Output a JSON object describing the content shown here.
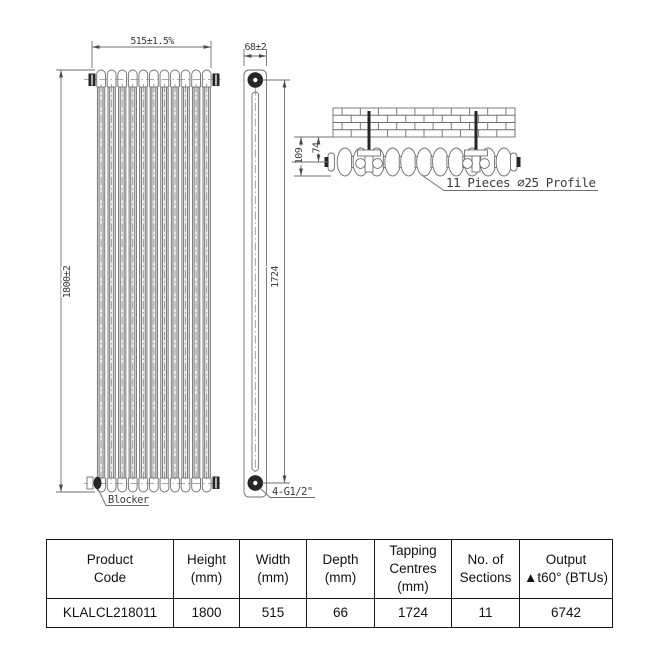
{
  "drawing": {
    "front": {
      "width_dim": "515±1.5%",
      "height_dim": "1800±2",
      "blocker_label": "Blocker",
      "sections": 11
    },
    "side": {
      "depth_dim": "68±2",
      "tapping_dim": "1724",
      "connections_label": "4-G1/2\""
    },
    "top": {
      "wall_to_face_dim": "109",
      "wall_to_centre_dim": "74",
      "profile_label": "11 Pieces ∅25 Profile",
      "brick_rows": 4
    },
    "colors": {
      "line": "#6e6e6e",
      "dark_fill": "#262626",
      "text": "#3c3c3c"
    }
  },
  "table": {
    "headers": [
      "Product\nCode",
      "Height\n(mm)",
      "Width\n(mm)",
      "Depth\n(mm)",
      "Tapping\nCentres\n(mm)",
      "No. of\nSections",
      "Output\n▲t60° (BTUs)"
    ],
    "row": [
      "KLALCL218011",
      "1800",
      "515",
      "66",
      "1724",
      "11",
      "6742"
    ]
  }
}
